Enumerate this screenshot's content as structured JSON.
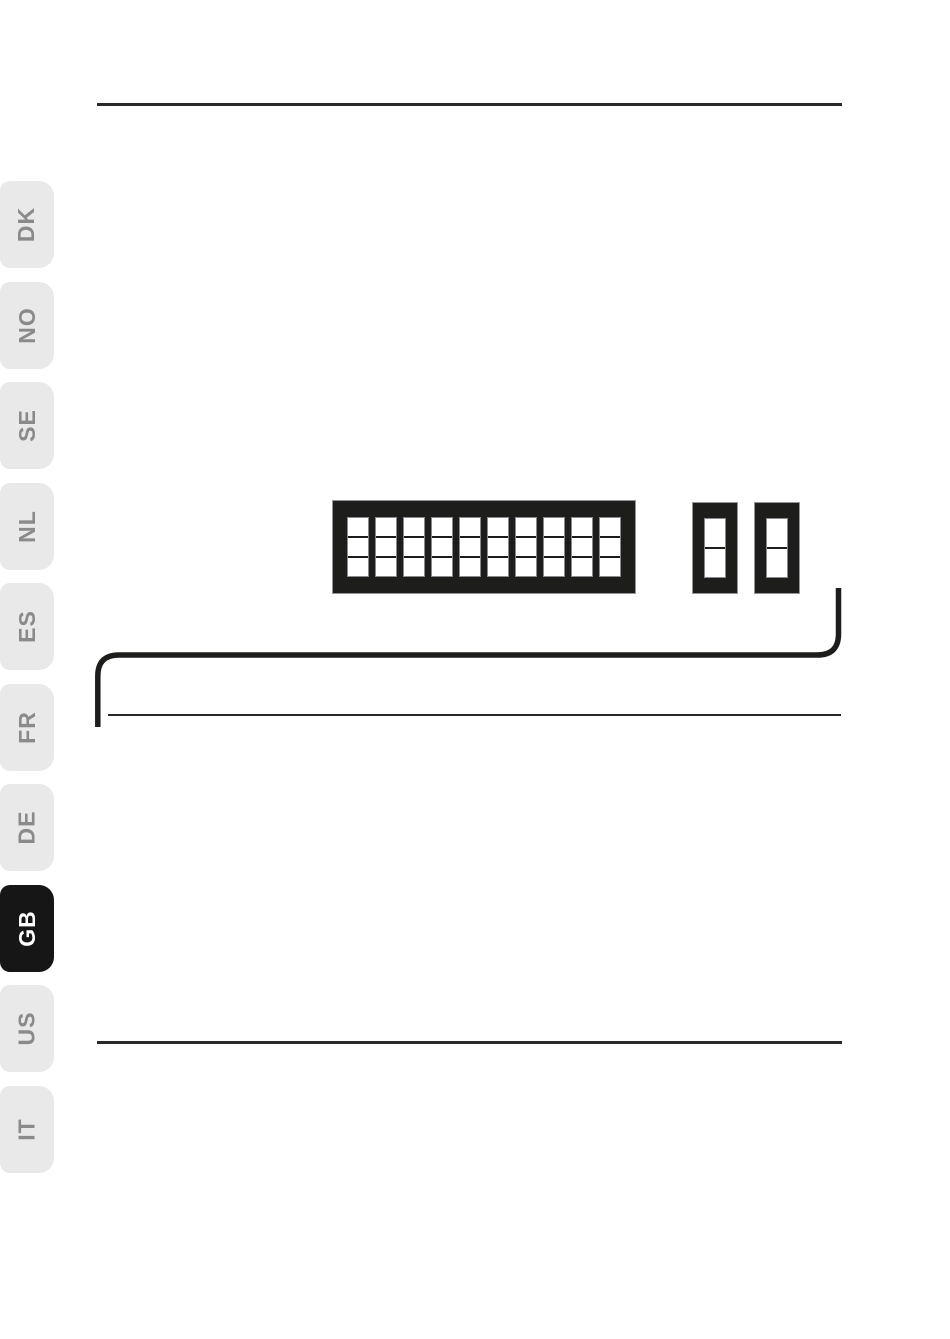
{
  "language_tabs": {
    "items": [
      {
        "code": "DK",
        "selected": false
      },
      {
        "code": "NO",
        "selected": false
      },
      {
        "code": "SE",
        "selected": false
      },
      {
        "code": "NL",
        "selected": false
      },
      {
        "code": "ES",
        "selected": false
      },
      {
        "code": "FR",
        "selected": false
      },
      {
        "code": "DE",
        "selected": false
      },
      {
        "code": "GB",
        "selected": true
      },
      {
        "code": "US",
        "selected": false
      },
      {
        "code": "IT",
        "selected": false
      }
    ],
    "colors": {
      "inactive_bg": "#e9e9e9",
      "inactive_text": "#8a8a8a",
      "active_bg": "#161616",
      "active_text": "#ffffff"
    }
  },
  "diagram": {
    "dip_switch_bank": {
      "positions": 10,
      "cells_per_position": 3
    },
    "single_switches": [
      {
        "cells": 2
      },
      {
        "cells": 2
      }
    ],
    "ink_color": "#1d1d1b"
  }
}
